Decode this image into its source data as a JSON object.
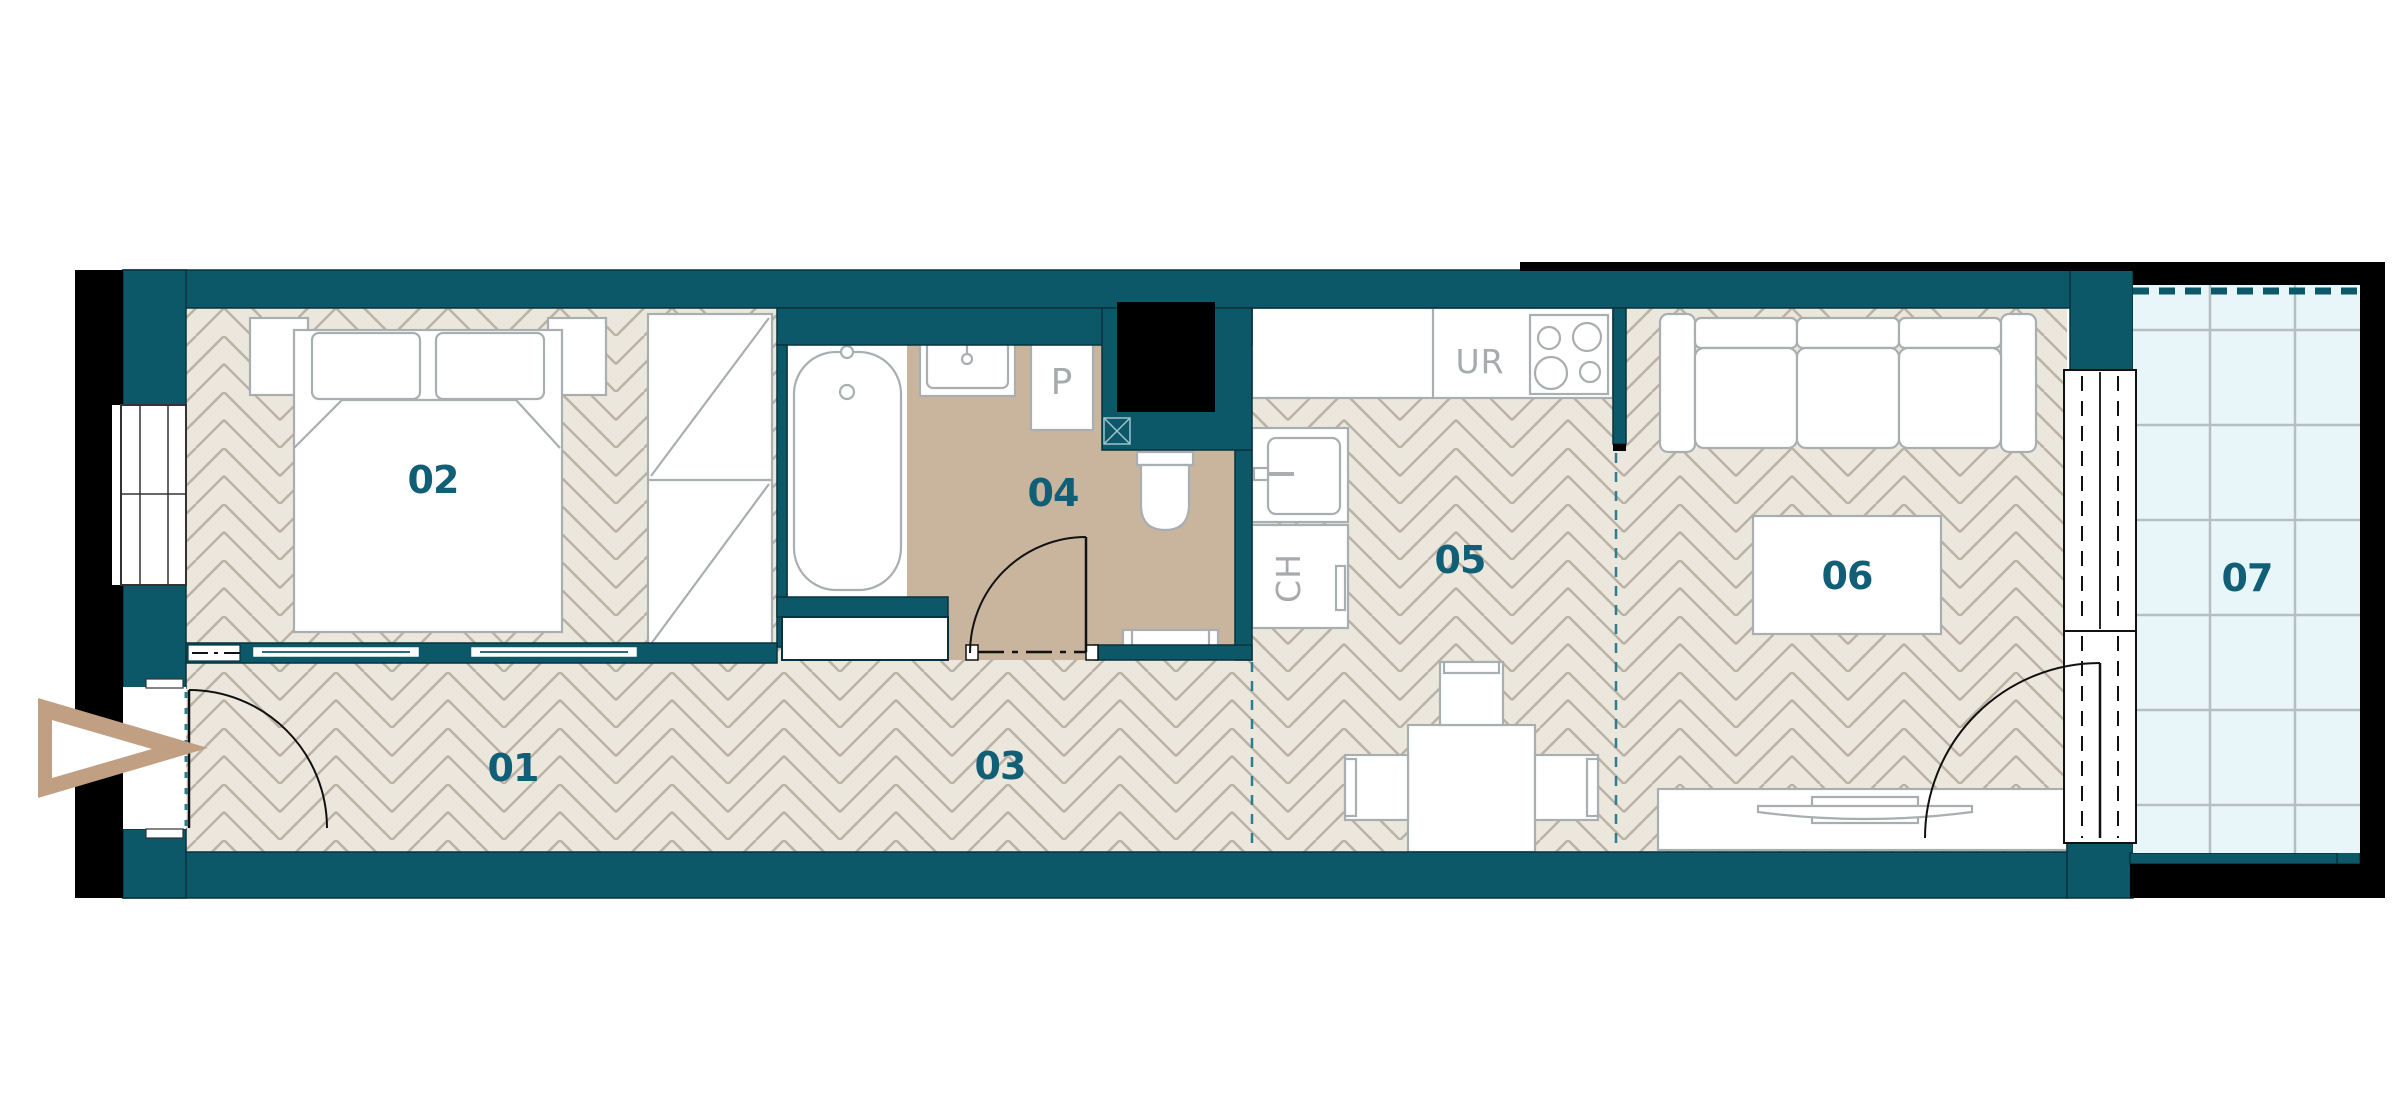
{
  "title": "Apartment unit floor plan",
  "rooms": {
    "r01": "01",
    "r02": "02",
    "r03": "03",
    "r04": "04",
    "r05": "05",
    "r06": "06",
    "r07": "07"
  },
  "fixtures": {
    "ur": "UR",
    "ch": "CH",
    "p": "P"
  },
  "colors": {
    "wall_teal": "#0c5869",
    "label_teal": "#115f76",
    "floor_beige": "#ece7dd",
    "floor_line": "#b9b1a4",
    "bath_tan": "#c9b49e",
    "balcony_blue": "#e9f6f9",
    "balcony_line": "#b3bfc1",
    "outline_black": "#000000",
    "furniture_gray": "#a9aeb0",
    "entry_arrow_tan": "#c19f83",
    "dash_teal": "#2d7d8e"
  }
}
